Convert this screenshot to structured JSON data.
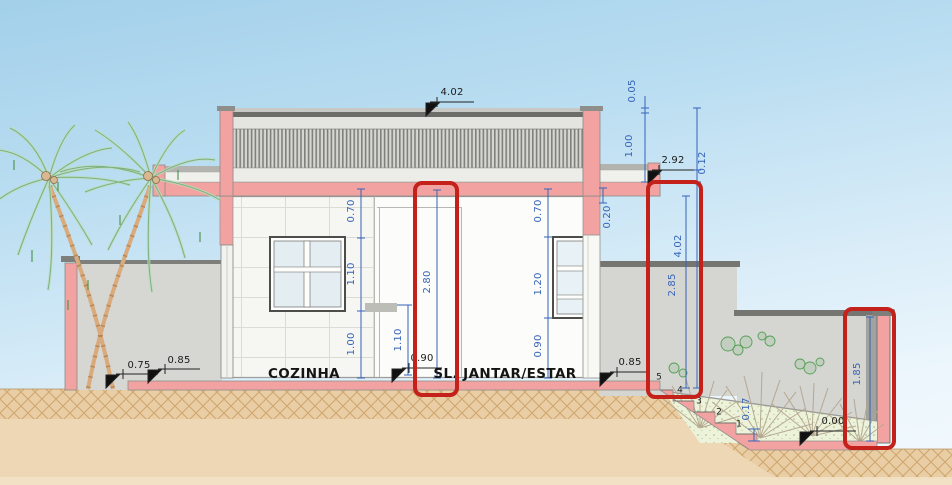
{
  "drawing": {
    "rooms": {
      "kitchen": "COZINHA",
      "living": "SL. JANTAR/ESTAR"
    },
    "levels": {
      "roof_top": "4.02",
      "canopy_right": "2.92",
      "yard_front": "0.75",
      "yard_terrace": "0.85",
      "hall_floor": "0.90",
      "terrace_right": "0.85",
      "garden_floor": "0.00"
    },
    "dims": {
      "roof_lip": "0.05",
      "roof_band": "1.00",
      "slab_edge": "0.12",
      "beam_right": "0.20",
      "kitchen_above_window": "0.70",
      "kitchen_window": "1.10",
      "kitchen_below_window": "1.00",
      "counter_height": "1.10",
      "ceiling_height": "2.80",
      "living_above_window": "0.70",
      "living_window": "1.20",
      "living_sill": "0.90",
      "total_height_right": "4.02",
      "wall_height_right": "2.85",
      "garden_step": "0.17",
      "garden_wall_height": "1.85"
    },
    "step_numbers": [
      "5",
      "4",
      "3",
      "2",
      "1"
    ],
    "colors": {
      "cut_masonry": "#f2a3a1",
      "dimension_blue": "#3563b8",
      "highlight_red": "#c3211a",
      "sky": "#a3d0ea",
      "soil": "#ecd3ae"
    }
  }
}
